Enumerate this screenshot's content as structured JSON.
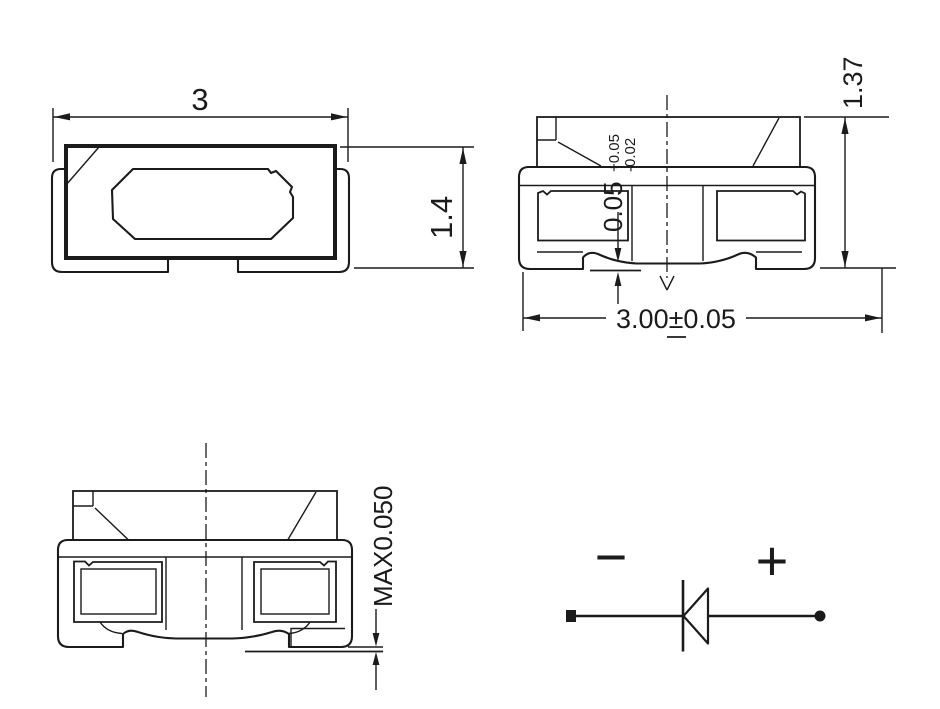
{
  "colors": {
    "background": "#ffffff",
    "line": "#1b1b1b"
  },
  "views": {
    "top_view": {
      "width_dim": "3",
      "depth_dim": "1.4"
    },
    "side_view": {
      "overall_height_dim": "1.37",
      "standoff_value": "0.05",
      "standoff_tol_upper": "+0.05",
      "standoff_tol_lower": "-0.02",
      "overall_width_dim": "3.00±0.05"
    },
    "front_view": {
      "standoff_max_dim": "MAX0.050"
    },
    "polarity": {
      "cathode_label": "−",
      "anode_label": "+"
    }
  }
}
